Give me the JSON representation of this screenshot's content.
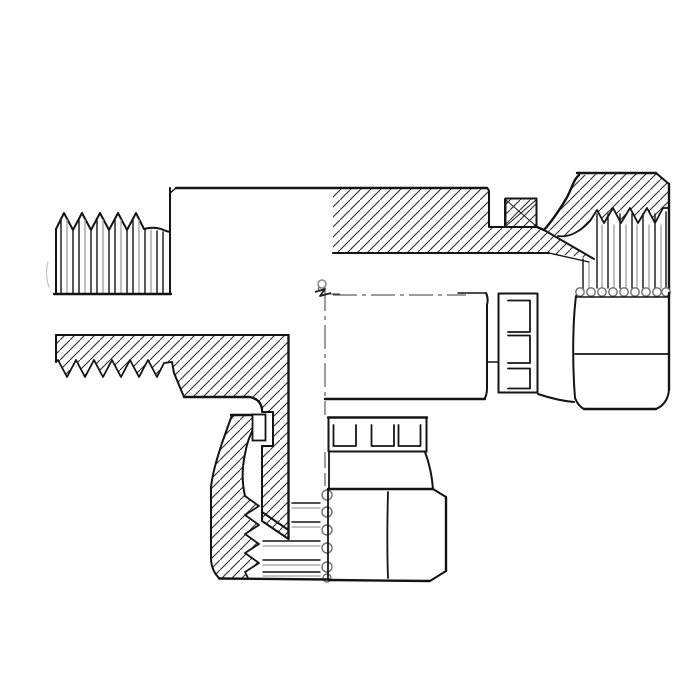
{
  "meta": {
    "kind": "technical-line-drawing",
    "description": "Cross-section half-section drawing of a hydraulic tee adapter fitting: male threaded stud on the left, female swivel nut port on the right, female swivel nut port on the bottom. No text or dimensions are shown in the drawing."
  },
  "colors": {
    "background": "#ffffff",
    "line": "#141414",
    "hatch": "#3c3c3c",
    "soft": "#9e9e9e",
    "faint": "#c4c4c4"
  },
  "parts": [
    "male-thread-left",
    "body-upper-wall-section",
    "retaining-ring-right",
    "swivel-nut-right-section",
    "swivel-nut-right-exterior",
    "slotted-collar-right",
    "body-lower-wall-section",
    "branch-wall-section",
    "retaining-ring-bottom",
    "swivel-nut-bottom-section",
    "swivel-nut-bottom-exterior",
    "slotted-collar-bottom",
    "centerline-horizontal",
    "centerline-vertical",
    "center-intersection-marker"
  ]
}
